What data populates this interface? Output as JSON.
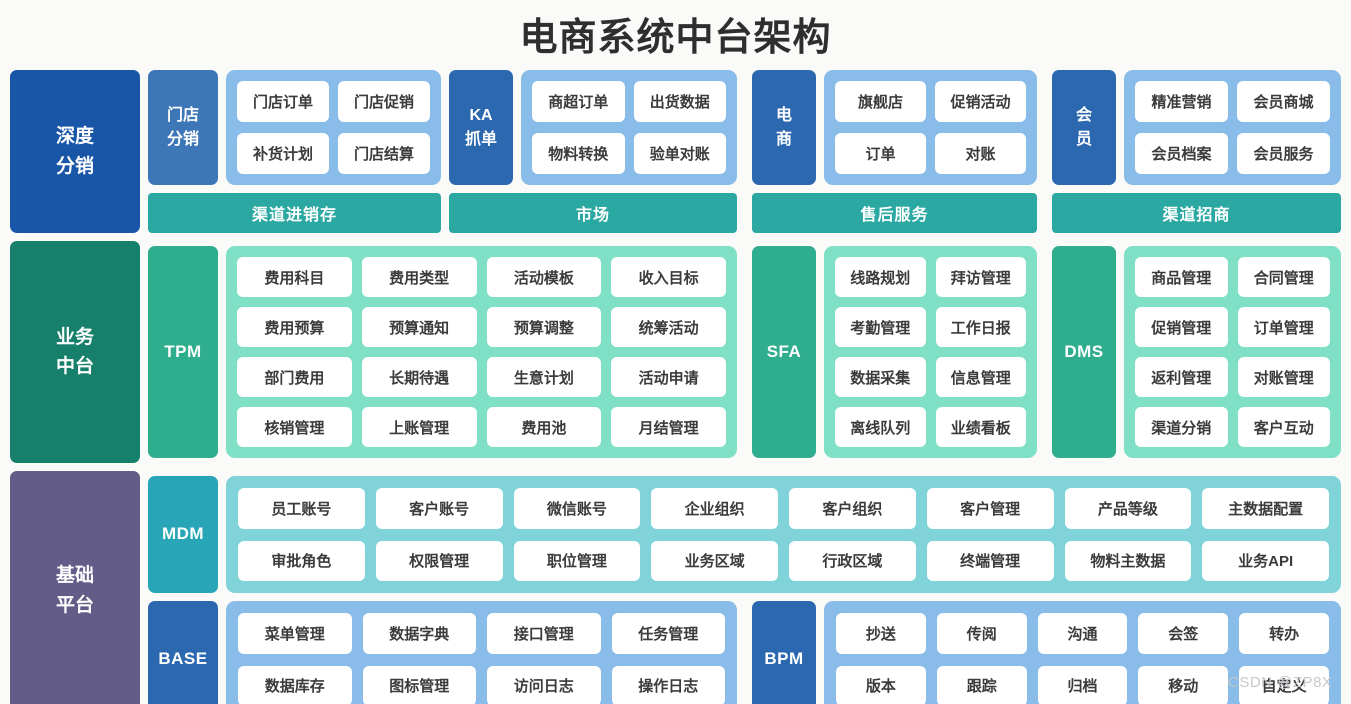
{
  "title": "电商系统中台架构",
  "watermark": "CSDN @ZP8X",
  "palette": {
    "background": "#fafaf8",
    "title_text": "#2e2e2e",
    "deep_blue": "#1a56a8",
    "mid_blue": "#3d77b8",
    "strong_blue": "#2c68b0",
    "light_blue": "#8abce9",
    "teal_bar": "#2aa8a1",
    "dark_green": "#17806a",
    "mid_green": "#2fae8d",
    "light_green": "#80e0c5",
    "purple": "#635c88",
    "cyan": "#28a5b6",
    "light_cyan": "#7fd3d9",
    "chip_bg": "#ffffff",
    "chip_text": "#3b3b3b"
  },
  "layers": {
    "depth_distribution": {
      "label": "深度\n分销",
      "groups": {
        "store": {
          "tag": "门店\n分销",
          "items": [
            "门店订单",
            "门店促销",
            "补货计划",
            "门店结算"
          ]
        },
        "ka": {
          "tag": "KA\n抓单",
          "items": [
            "商超订单",
            "出货数据",
            "物料转换",
            "验单对账"
          ]
        },
        "ecommerce": {
          "tag": "电\n商",
          "items": [
            "旗舰店",
            "促销活动",
            "订单",
            "对账"
          ]
        },
        "member": {
          "tag": "会\n员",
          "items": [
            "精准营销",
            "会员商城",
            "会员档案",
            "会员服务"
          ]
        }
      },
      "bars": [
        "渠道进销存",
        "市场",
        "售后服务",
        "渠道招商"
      ]
    },
    "business_middle": {
      "label": "业务\n中台",
      "groups": {
        "tpm": {
          "tag": "TPM",
          "items": [
            "费用科目",
            "费用类型",
            "活动模板",
            "收入目标",
            "费用预算",
            "预算通知",
            "预算调整",
            "统筹活动",
            "部门费用",
            "长期待遇",
            "生意计划",
            "活动申请",
            "核销管理",
            "上账管理",
            "费用池",
            "月结管理"
          ]
        },
        "sfa": {
          "tag": "SFA",
          "items": [
            "线路规划",
            "拜访管理",
            "考勤管理",
            "工作日报",
            "数据采集",
            "信息管理",
            "离线队列",
            "业绩看板"
          ]
        },
        "dms": {
          "tag": "DMS",
          "items": [
            "商品管理",
            "合同管理",
            "促销管理",
            "订单管理",
            "返利管理",
            "对账管理",
            "渠道分销",
            "客户互动"
          ]
        }
      }
    },
    "base_platform": {
      "label": "基础\n平台",
      "groups": {
        "mdm": {
          "tag": "MDM",
          "items": [
            "员工账号",
            "客户账号",
            "微信账号",
            "企业组织",
            "客户组织",
            "客户管理",
            "产品等级",
            "主数据配置",
            "审批角色",
            "权限管理",
            "职位管理",
            "业务区域",
            "行政区域",
            "终端管理",
            "物料主数据",
            "业务API"
          ]
        },
        "base": {
          "tag": "BASE",
          "items": [
            "菜单管理",
            "数据字典",
            "接口管理",
            "任务管理",
            "数据库存",
            "图标管理",
            "访问日志",
            "操作日志"
          ]
        },
        "bpm": {
          "tag": "BPM",
          "items": [
            "抄送",
            "传阅",
            "沟通",
            "会签",
            "转办",
            "版本",
            "跟踪",
            "归档",
            "移动",
            "自定义"
          ]
        }
      }
    }
  }
}
